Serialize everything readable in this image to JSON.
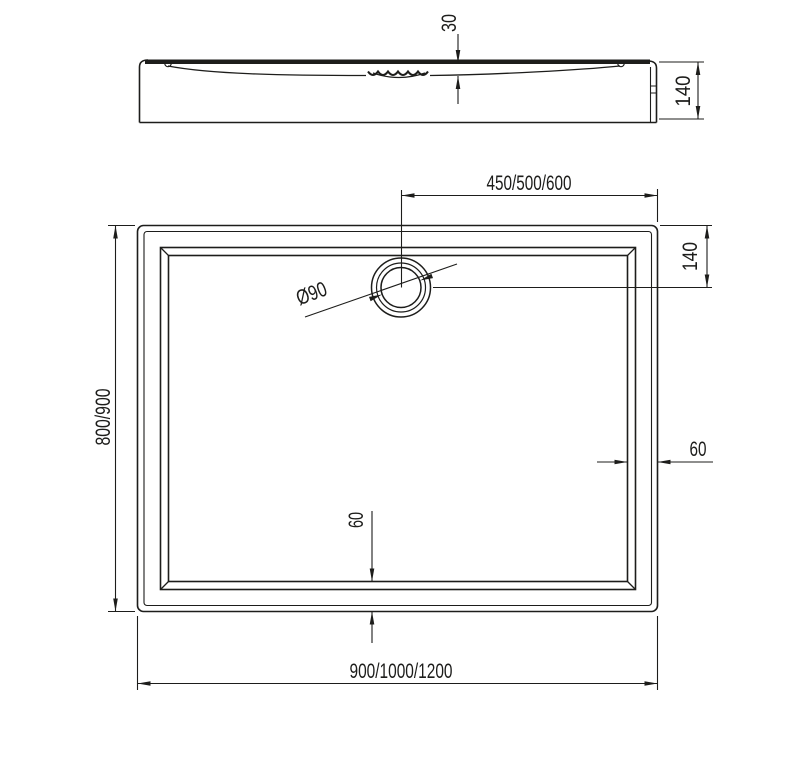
{
  "colors": {
    "line": "#1d1d1b",
    "background": "#ffffff"
  },
  "side_view": {
    "depth": "30",
    "height": "140"
  },
  "plan_view": {
    "drain_offset_horizontal": "450/500/600",
    "drain_offset_vertical": "140",
    "drain_diameter": "Ø90",
    "width_options": "800/900",
    "rim_width_right": "60",
    "rim_width_bottom": "60",
    "length_options": "900/1000/1200"
  }
}
